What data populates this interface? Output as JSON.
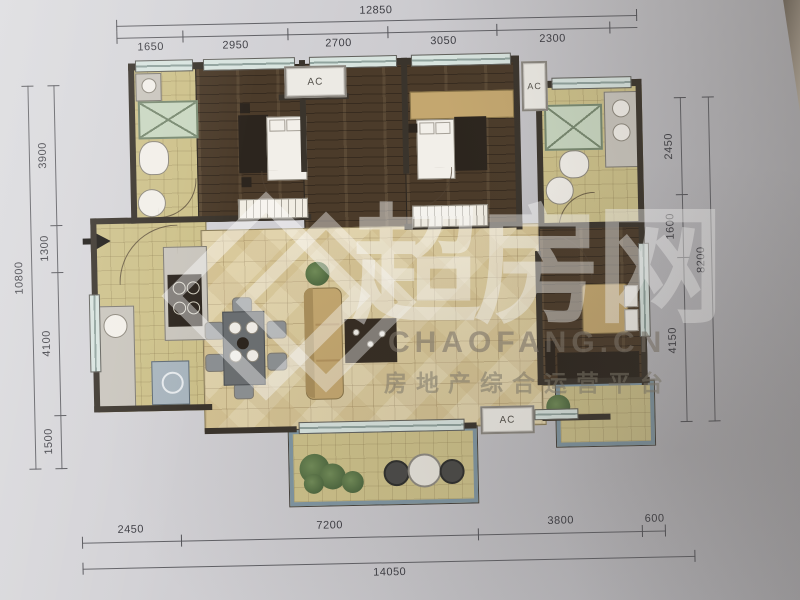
{
  "dimensions": {
    "top": {
      "total": "12850",
      "segments": [
        "1650",
        "2950",
        "2700",
        "3050",
        "2300"
      ]
    },
    "bottom": {
      "total": "14050",
      "segments": [
        "2450",
        "7200",
        "3800",
        "600"
      ]
    },
    "left": {
      "total": "10800",
      "segments": [
        "3900",
        "1300",
        "4100",
        "1500"
      ]
    },
    "right": {
      "total": "8200",
      "segments": [
        "2450",
        "1600",
        "4150"
      ]
    }
  },
  "ac_units": {
    "top": "AC",
    "right": "AC",
    "bottom": "AC"
  },
  "watermark": {
    "brand": "超房网",
    "domain": "CHAOFANG.CN",
    "tagline": "房地产综合运营平台"
  },
  "palette": {
    "paper": "#c9c8cc",
    "wall": "#3b342b",
    "wood_floor": "#4d3b28",
    "tile_floor": "#dbc996",
    "yellow_floor": "#cfc184",
    "shower_green": "#c8d7bf",
    "balcony_frame": "#7e96a4",
    "dim_line": "#606066"
  }
}
